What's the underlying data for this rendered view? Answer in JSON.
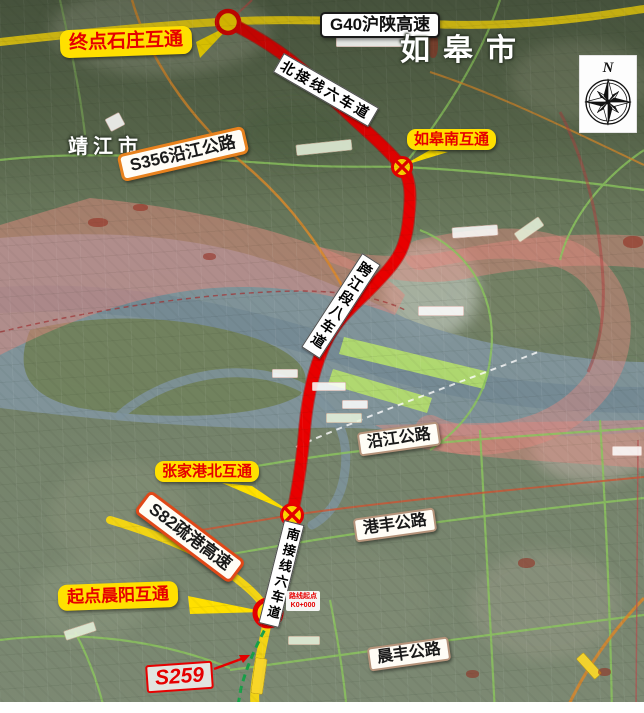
{
  "map": {
    "cities": {
      "rugao": "如皋市",
      "jingjiang": "靖江市"
    },
    "interchanges": {
      "end": {
        "label": "终点石庄互通"
      },
      "rugao_south": {
        "label": "如皋南互通"
      },
      "zjg_north": {
        "label": "张家港北互通"
      },
      "start": {
        "label": "起点晨阳互通"
      }
    },
    "roads": {
      "g40": "G40沪陕高速",
      "s356": "S356沿江公路",
      "yanjiang": "沿江公路",
      "gangfeng": "港丰公路",
      "chenfeng": "晨丰公路",
      "s82": "S82疏港高速",
      "s259": "S259"
    },
    "route_sections": {
      "north": "北接线六车道",
      "river": "跨江段八车道",
      "south": "南接线六车道"
    },
    "milestone": {
      "line1": "路线起点",
      "line2": "K0+000"
    },
    "compass": {
      "north": "N"
    },
    "colors": {
      "route_red": "#e80000",
      "highway_yellow": "#f2d414",
      "bubble_yellow": "#ffe000",
      "bubble_text_red": "#e60000",
      "planned_green": "#18a048",
      "water": "#81959d",
      "overlay_pink": "#e2887e"
    }
  }
}
